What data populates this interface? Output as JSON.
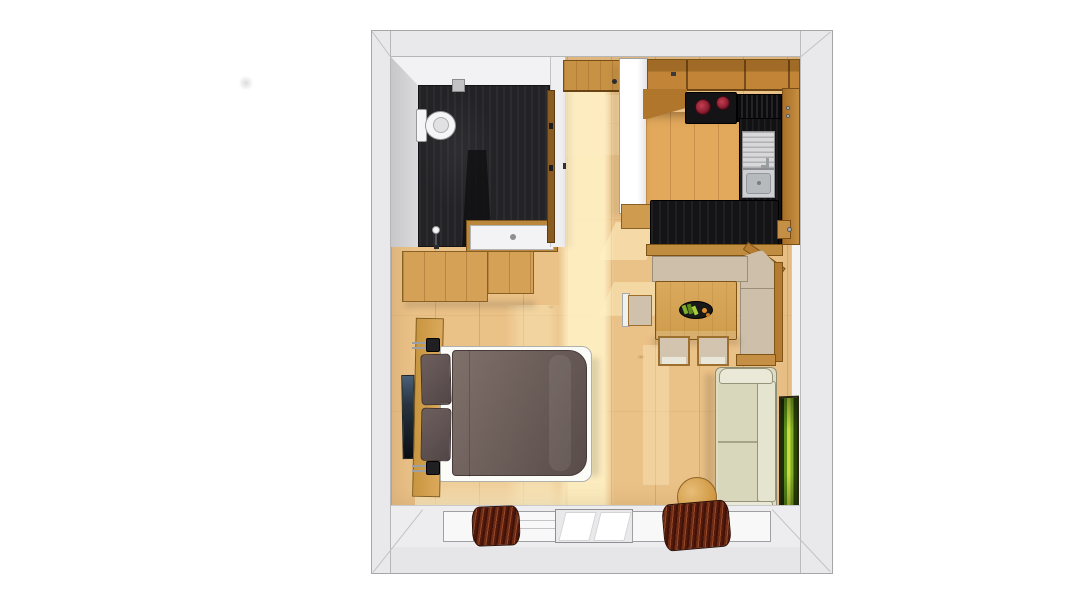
{
  "scene": {
    "description": "Top-down 3D rendering of a studio apartment floor plan on a white background",
    "rooms": [
      {
        "name": "bathroom",
        "position": "top-left",
        "floor": "dark slate tile"
      },
      {
        "name": "entry-hall",
        "position": "top-center",
        "floor": "light wood"
      },
      {
        "name": "kitchen",
        "position": "top-right",
        "floor": "warm wood"
      },
      {
        "name": "dining-nook",
        "position": "center-right",
        "floor": "light wood"
      },
      {
        "name": "sleeping-area",
        "position": "center-left",
        "floor": "light wood planks"
      },
      {
        "name": "living-area",
        "position": "right",
        "floor": "light wood planks"
      }
    ],
    "fixtures": [
      {
        "name": "toilet",
        "room": "bathroom"
      },
      {
        "name": "washbasin-vanity",
        "room": "bathroom"
      },
      {
        "name": "shower-fixture",
        "room": "bathroom"
      },
      {
        "name": "wall-vent",
        "room": "bathroom"
      },
      {
        "name": "bathroom-door",
        "room": "bathroom"
      },
      {
        "name": "entry-door",
        "room": "entry-hall"
      },
      {
        "name": "tall-white-cabinet",
        "room": "entry-hall"
      },
      {
        "name": "upper-cabinet-row",
        "room": "kitchen"
      },
      {
        "name": "cooktop-two-red-burners",
        "room": "kitchen"
      },
      {
        "name": "sink-with-drainboard",
        "room": "kitchen"
      },
      {
        "name": "dark-counter-run",
        "room": "kitchen"
      },
      {
        "name": "black-bar-counter",
        "room": "kitchen"
      },
      {
        "name": "corner-bench",
        "room": "dining-nook"
      },
      {
        "name": "dining-table",
        "room": "dining-nook"
      },
      {
        "name": "plate-of-food",
        "room": "dining-nook"
      },
      {
        "name": "chair",
        "count": 3,
        "room": "dining-nook"
      },
      {
        "name": "double-bed-with-duvet-and-pillows",
        "room": "sleeping-area"
      },
      {
        "name": "headboard-reading-light",
        "count": 2,
        "room": "sleeping-area"
      },
      {
        "name": "wood-dresser",
        "room": "sleeping-area"
      },
      {
        "name": "wall-mounted-tv",
        "room": "sleeping-area"
      },
      {
        "name": "sofa",
        "room": "living-area"
      },
      {
        "name": "round-side-stool",
        "room": "living-area"
      },
      {
        "name": "green-wall-artwork",
        "room": "living-area"
      },
      {
        "name": "pleated-curtain",
        "count": 2,
        "room": "window-wall"
      },
      {
        "name": "window-band",
        "room": "window-wall"
      }
    ]
  },
  "palette": {
    "bg": "#ffffff",
    "wall": "#e9e9eb",
    "floor-wood": "#eac187",
    "kitchen-floor": "#e2a85b",
    "cabinet-wood": "#c28538",
    "trim-wood": "#b57c31",
    "counter-black": "#141417",
    "burner-red": "#a02438",
    "bath-floor": "#232327",
    "duvet": "#6d5f5a",
    "pillow": "#5c4e4d",
    "cushion": "#cdbfaa",
    "sofa": "#dedcc3",
    "curtain": "#5a1d0c",
    "art-green": "#7fae24",
    "sunlight": "#fff3c8"
  }
}
